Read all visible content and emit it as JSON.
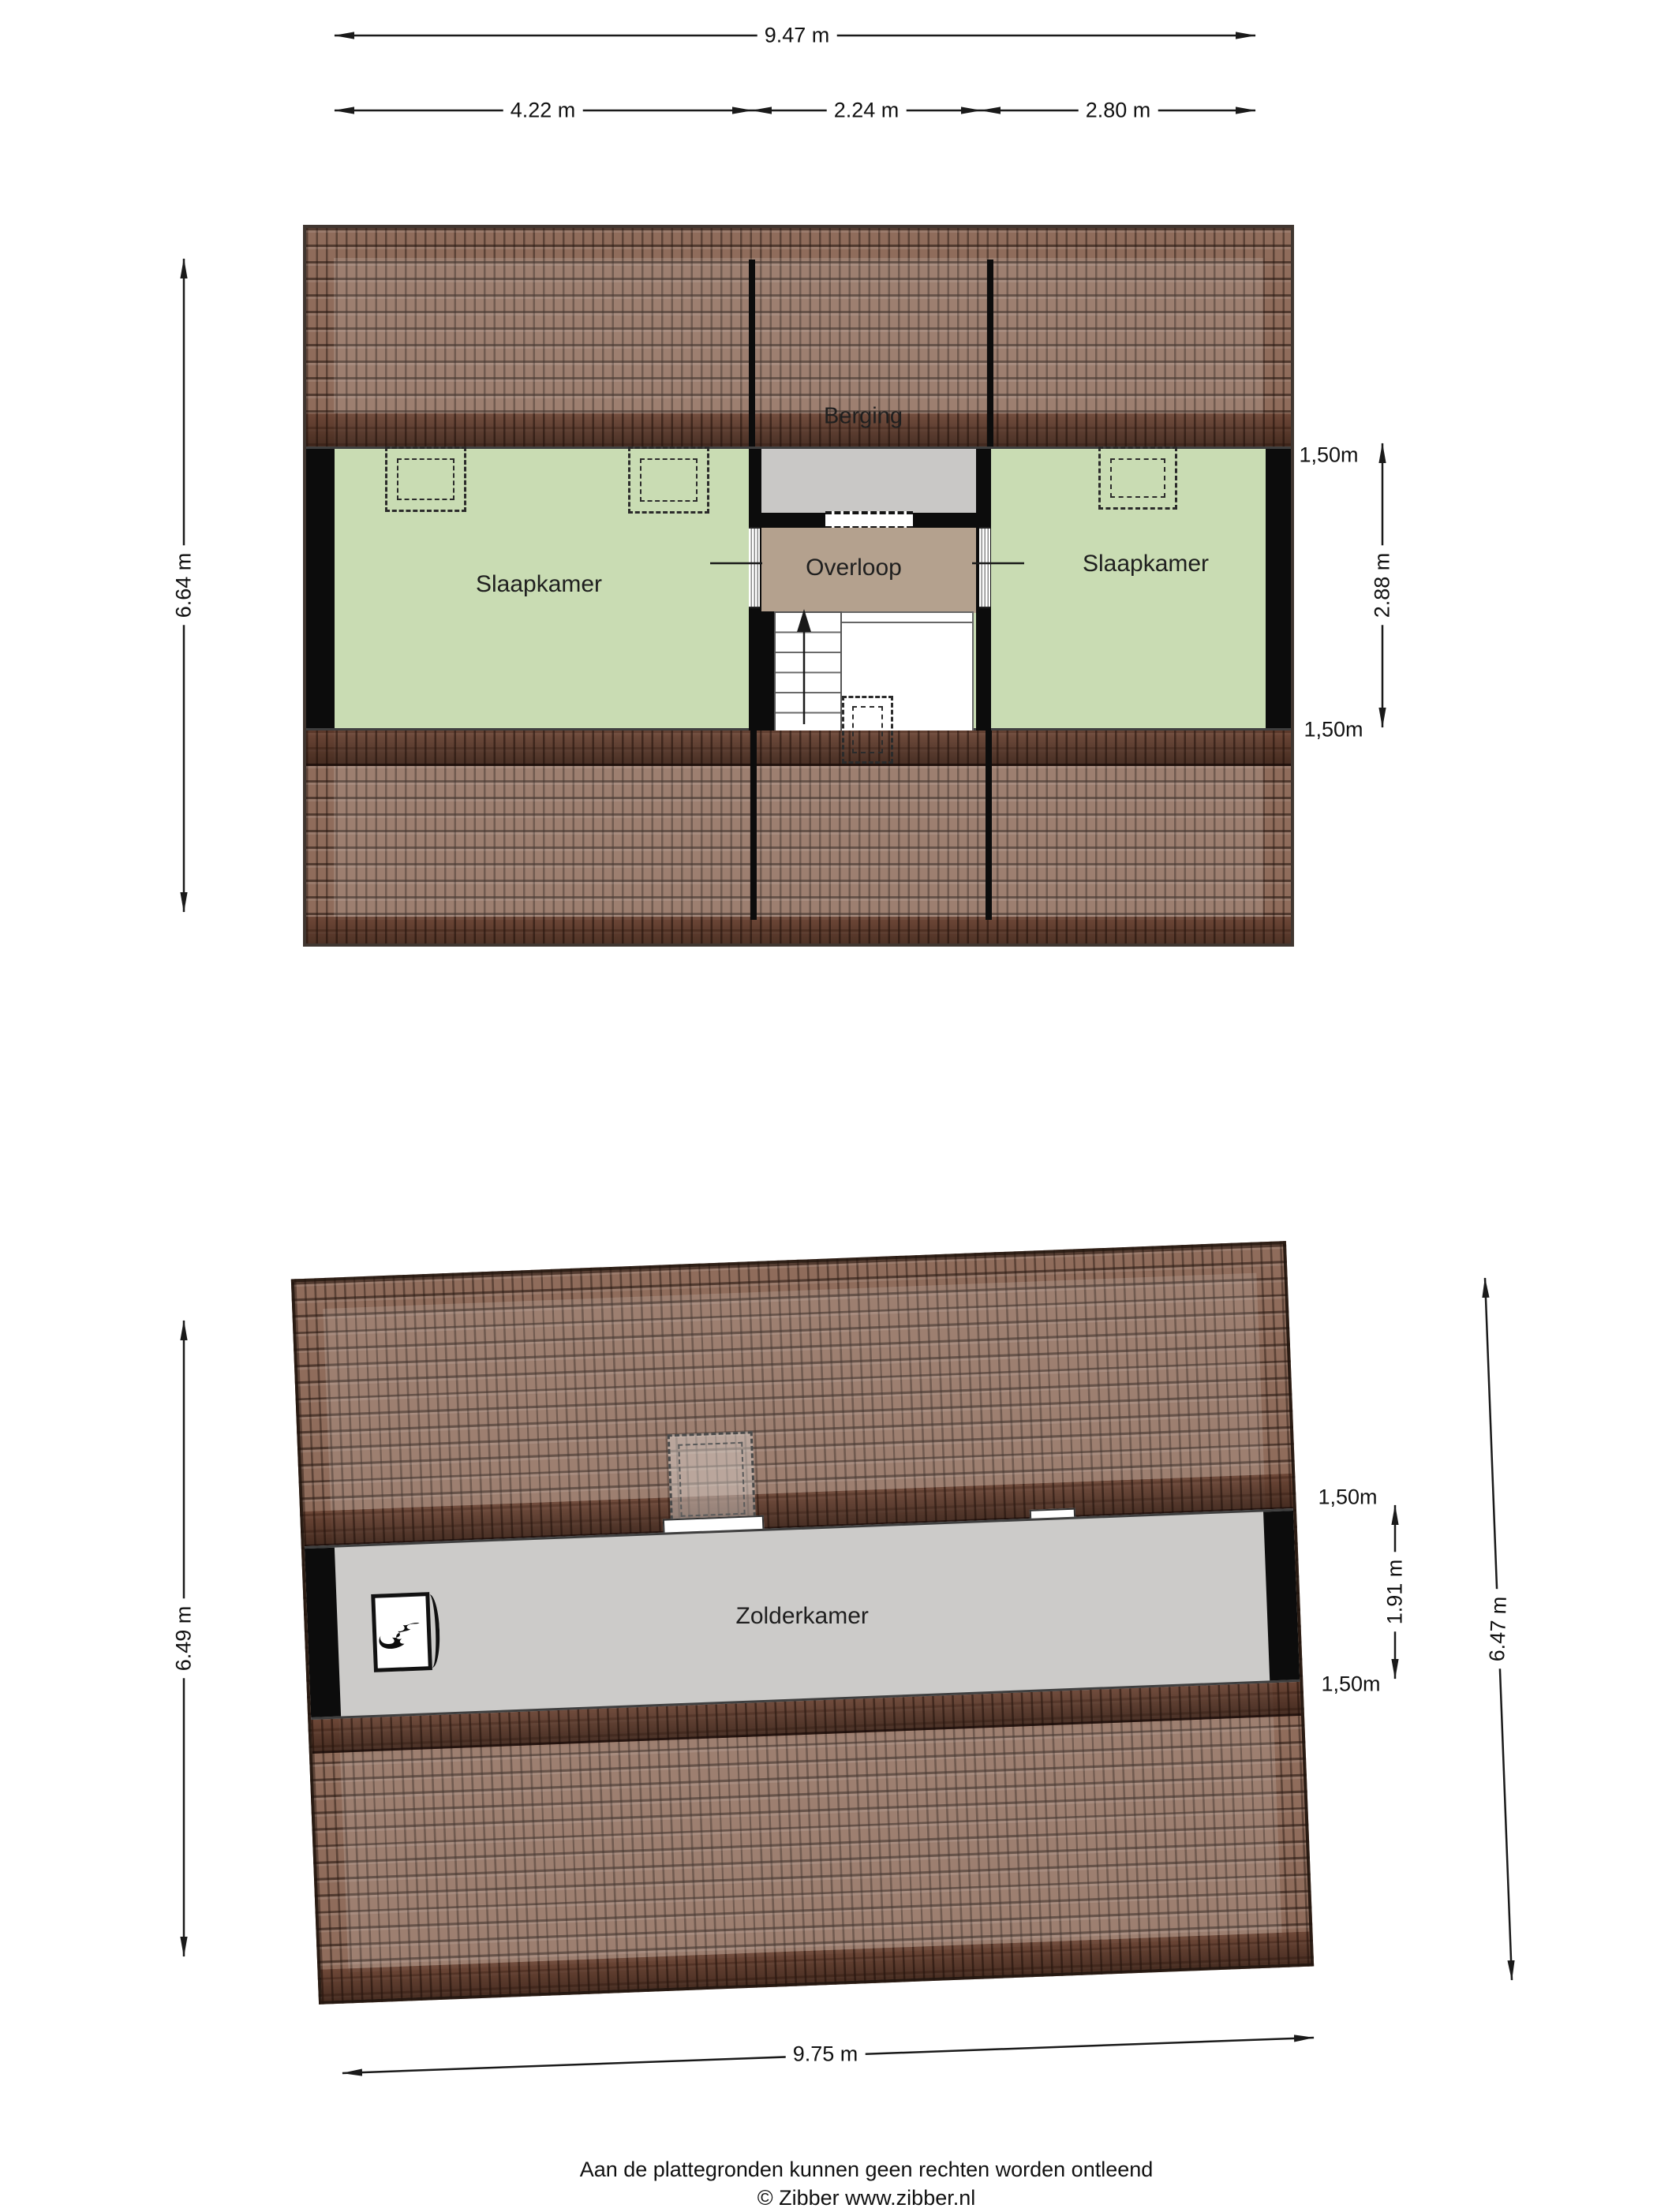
{
  "colors": {
    "tile_base": "#8f6c5b",
    "wall": "#0c0c0c",
    "bedroom_green": "#c9dcb3",
    "storage_gray": "#c9c8c6",
    "landing_tan": "#b4a18e",
    "attic_gray": "#cccbc9",
    "dimension_text": "#111111"
  },
  "floor1": {
    "rooms": {
      "berging": "Berging",
      "bedroom_left": "Slaapkamer",
      "landing": "Overloop",
      "bedroom_right": "Slaapkamer"
    },
    "dims": {
      "total_width": "9.47 m",
      "left_width": "4.22 m",
      "mid_width": "2.24 m",
      "right_width": "2.80 m",
      "total_height": "6.64 m",
      "knee_top": "1,50m",
      "room_height": "2.88 m",
      "knee_bottom": "1,50m"
    }
  },
  "floor2": {
    "rooms": {
      "attic": "Zolderkamer"
    },
    "dims": {
      "total_height_left": "6.49 m",
      "knee_top": "1,50m",
      "room_height": "1.91 m",
      "knee_bottom": "1,50m",
      "total_height_right": "6.47 m",
      "total_width": "9.75 m"
    },
    "icons": {
      "fireplace": "fireplace-flame"
    }
  },
  "footer": {
    "disclaimer": "Aan de plattegronden kunnen geen rechten worden ontleend",
    "credit": "© Zibber www.zibber.nl"
  }
}
